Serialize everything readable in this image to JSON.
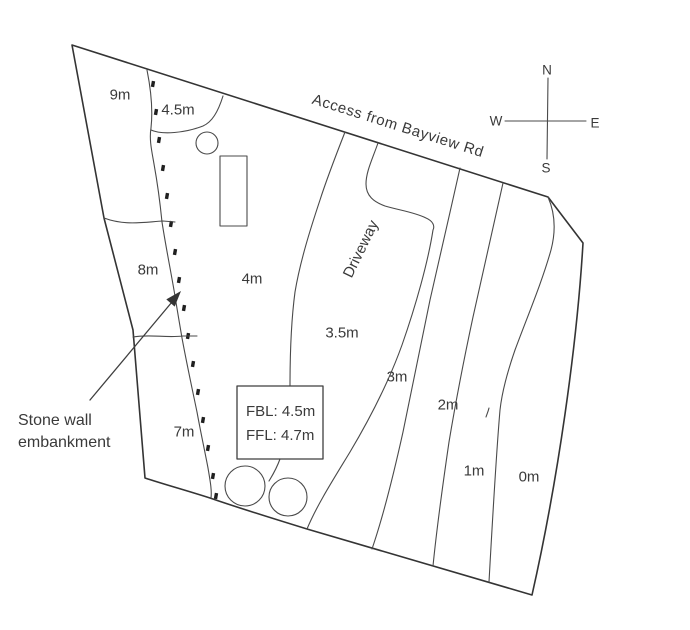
{
  "diagram_title": "Site contour plan",
  "road_label": "Access from Bayview Rd",
  "driveway_label": "Driveway",
  "annotation": {
    "line1": "Stone wall",
    "line2": "embankment"
  },
  "levels_box": {
    "line1": "FBL: 4.5m",
    "line2": "FFL: 4.7m"
  },
  "compass": {
    "north": "N",
    "south": "S",
    "west": "W",
    "east": "E"
  },
  "contours": {
    "c9": "9m",
    "c45": "4.5m",
    "c8": "8m",
    "c7": "7m",
    "c4": "4m",
    "c35": "3.5m",
    "c3": "3m",
    "c2": "2m",
    "c1": "1m",
    "c0": "0m"
  },
  "colors": {
    "background": "#ffffff",
    "line": "#4a4a4a",
    "boundary": "#343434",
    "text": "#3a3a3a"
  }
}
